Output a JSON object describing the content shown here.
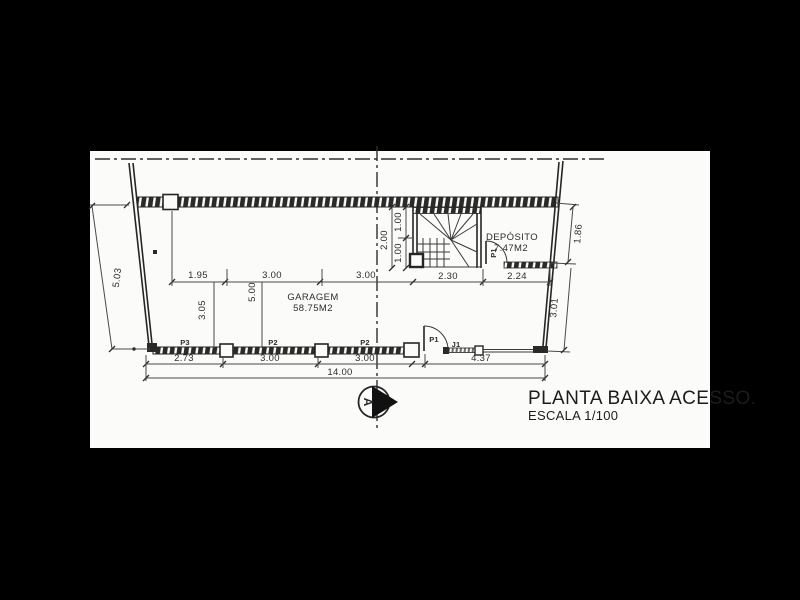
{
  "title": {
    "main": "PLANTA BAIXA ACESSO.",
    "scale": "ESCALA 1/100"
  },
  "rooms": {
    "garagem": {
      "name": "GARAGEM",
      "area": "58.75M2"
    },
    "deposito": {
      "name": "DEPÓSITO",
      "area": "7.47M2"
    }
  },
  "openings": {
    "p3": "P3",
    "p2a": "P2",
    "p2b": "P2",
    "p1_garage": "P1",
    "j1": "J1",
    "p1_deposito": "P1"
  },
  "dims": {
    "left_height": "5.03",
    "garage_a": "1.95",
    "garage_b": "3.00",
    "garage_c": "3.00",
    "stair_width": "2.30",
    "deposito_width": "2.24",
    "right_top": "1.86",
    "right_bottom": "3.01",
    "stair_total": "2.00",
    "stair_run_a": "1.00",
    "stair_run_b": "1.00",
    "depth_a": "3.05",
    "depth_b": "5.00",
    "bottom_a": "2.73",
    "bottom_b": "3.00",
    "bottom_c": "3.00",
    "bottom_d": "4.37",
    "total_width": "14.00"
  },
  "section_marker": {
    "letter": "A"
  },
  "colors": {
    "paper": "#fbfbf9",
    "line": "#2c2c2c",
    "frame": "#000000"
  }
}
